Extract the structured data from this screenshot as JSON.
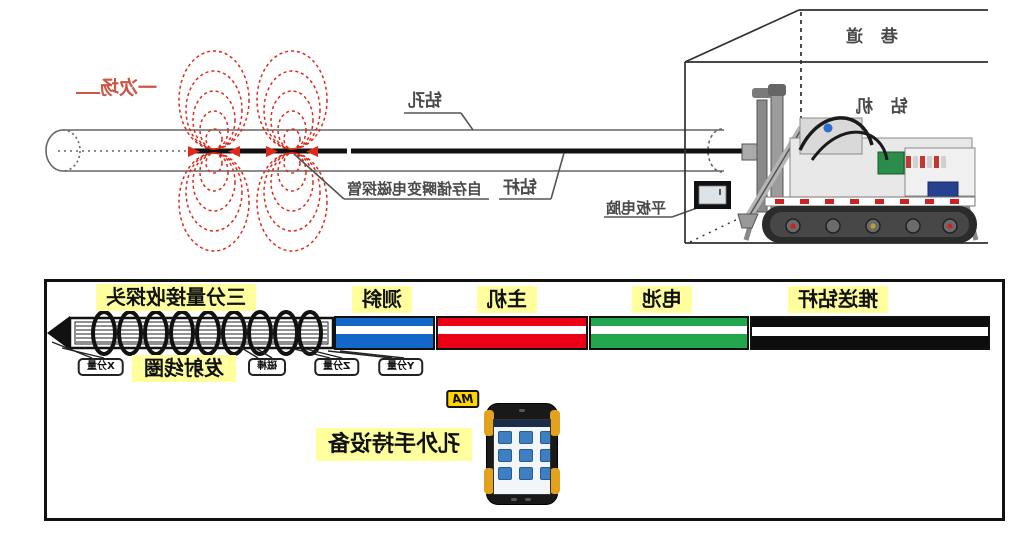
{
  "top_diagram": {
    "primary_field_label": "一次场",
    "borehole_label": "钻孔",
    "drill_rod_label": "钻杆",
    "probe_label": "自存储瞬变电磁探管",
    "tablet_label": "平板电脑",
    "tunnel_label": "巷 道",
    "drill_rig_label": "钻 机"
  },
  "bottom_diagram": {
    "section_labels": {
      "probe_head": "三分量接收探头",
      "inclinometer": "测斜",
      "main_unit": "主机",
      "battery": "电池",
      "push_rod": "推送钻杆"
    },
    "component_tags": {
      "x_component": "X分量",
      "transmit_coil": "发射线圈",
      "magnet_rod": "磁棒",
      "z_component": "Z分量",
      "y_component": "Y分量"
    },
    "ma_badge": "MA",
    "handheld_label": "孔外手持设备"
  },
  "colors": {
    "field_red": "#dd2a1a",
    "label_highlight": "#ffff9e",
    "segment_inclinometer_blue": "#1467c8",
    "segment_main_unit_red": "#ec0016",
    "segment_battery_green": "#22a74f",
    "segment_push_rod_black": "#0d0d0d",
    "ma_badge_yellow": "#ffd400"
  }
}
